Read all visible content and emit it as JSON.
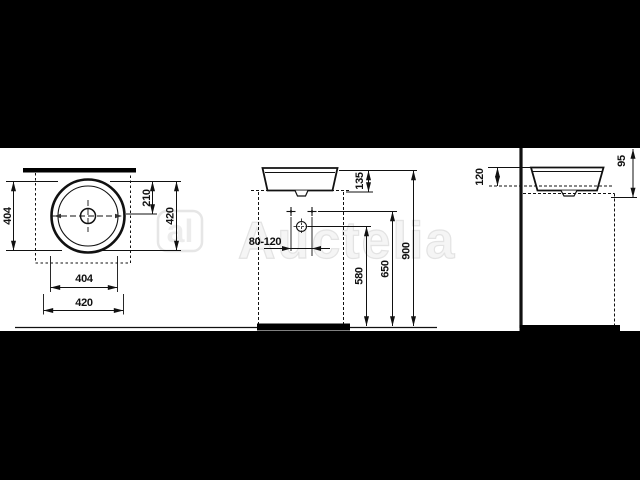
{
  "title": "washbasin-technical-drawing",
  "letterbox_color": "#000000",
  "line_color": "#111111",
  "watermark": {
    "logo_text": "al",
    "brand_text": "Auctelia"
  },
  "plan_view": {
    "dim_bowl_diameter_left": "404",
    "dim_center_offset": "210",
    "dim_depth": "420",
    "dim_bowl_diameter_bottom": "404",
    "dim_width": "420"
  },
  "front_view": {
    "dim_basin_height": "135",
    "dim_wall_clearance": "80-120",
    "dim_outlet_height": "580",
    "dim_fixing_height": "650",
    "dim_rim_height": "900"
  },
  "side_view": {
    "dim_rim_above_counter": "120",
    "dim_top_offset": "95"
  }
}
